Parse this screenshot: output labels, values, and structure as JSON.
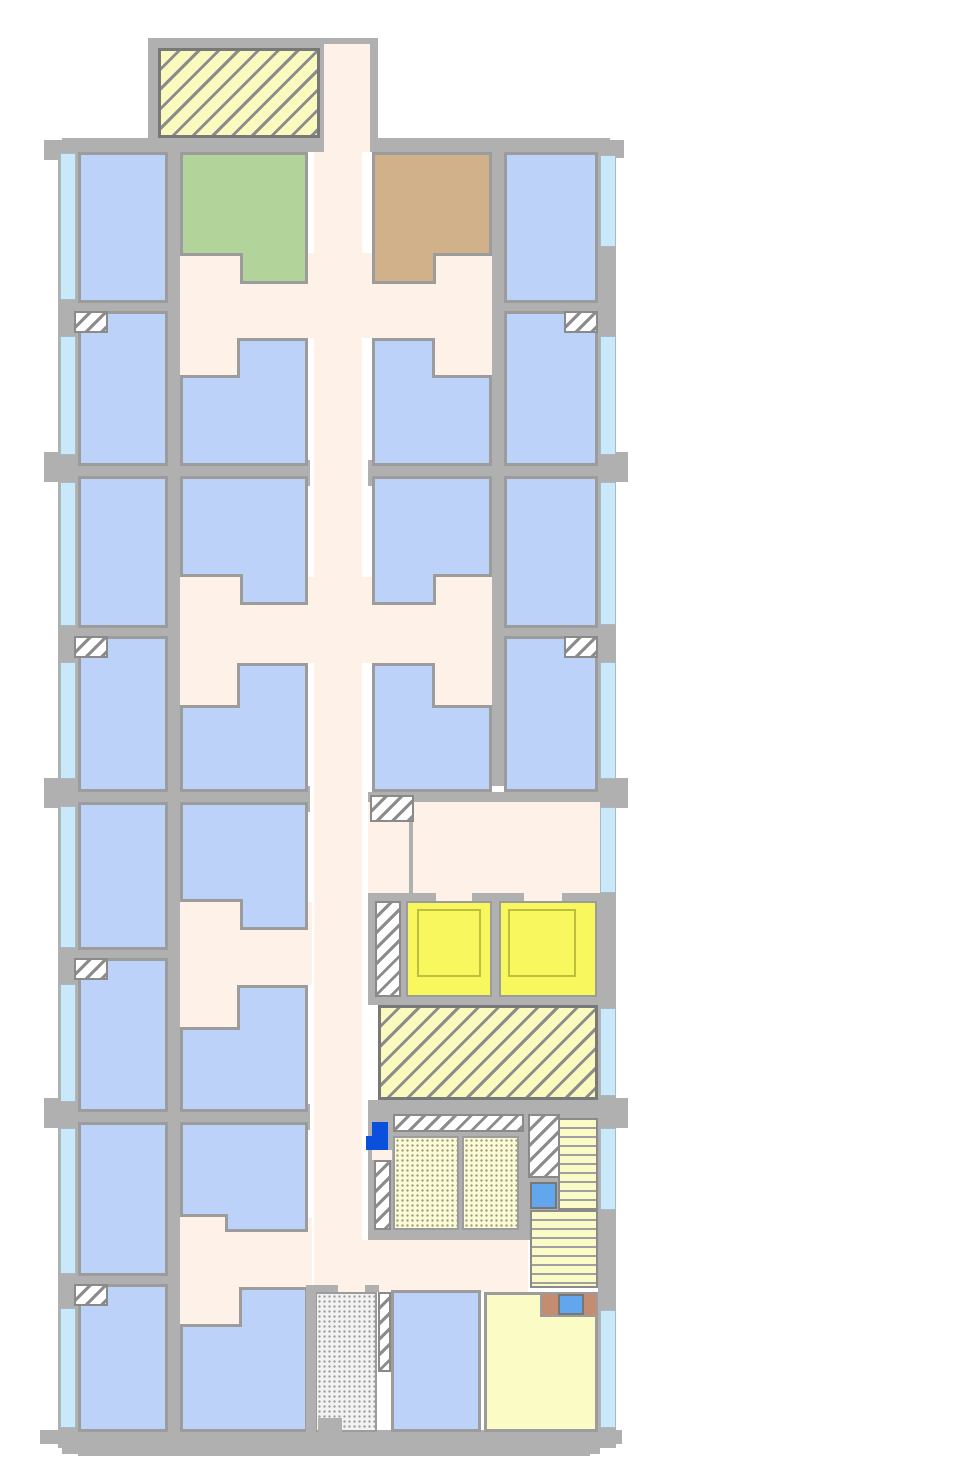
{
  "canvas": {
    "width": 960,
    "height": 1484,
    "background": "#ffffff"
  },
  "palette": {
    "wall_gray": "#b0b0b0",
    "wall_dark": "#8f8f8f",
    "corridor_cream": "#fdf1e8",
    "glazing_cyan": "#c9e9fb",
    "room_blue": "#bdd2f8",
    "room_green": "#b2d49a",
    "room_tan": "#d0b189",
    "pale_yellow": "#fafabe",
    "elevator_yellow": "#f8f85e",
    "equipment_blue": "#0a50dd",
    "landing_blue": "#62a7ee",
    "counter_brown": "#c48d72",
    "room_border": "#9c9c9c"
  },
  "shapes": [
    {
      "n": "annex-walls",
      "c": "wall",
      "r": [
        148,
        38,
        230,
        114
      ]
    },
    {
      "n": "facade-top-wall",
      "c": "wall",
      "r": [
        62,
        138,
        548,
        14
      ]
    },
    {
      "n": "facade-left-wall",
      "c": "wall",
      "r": [
        58,
        152,
        20,
        1284
      ]
    },
    {
      "n": "facade-right-wall",
      "c": "wall",
      "r": [
        598,
        152,
        18,
        1284
      ]
    },
    {
      "n": "facade-bottom-wall",
      "c": "wall",
      "r": [
        58,
        1430,
        558,
        18
      ]
    },
    {
      "n": "facade-bottom-lip",
      "c": "wall",
      "r": [
        78,
        1448,
        512,
        8
      ]
    },
    {
      "n": "corner-column-top-left",
      "c": "wall",
      "r": [
        44,
        140,
        40,
        20
      ]
    },
    {
      "n": "corner-column-top-right",
      "c": "wall",
      "r": [
        580,
        140,
        44,
        18
      ]
    },
    {
      "n": "corner-footing-bottom-left-a",
      "c": "wall",
      "r": [
        40,
        1430,
        48,
        14
      ]
    },
    {
      "n": "corner-footing-bottom-left-b",
      "c": "wall",
      "r": [
        62,
        1428,
        30,
        26
      ]
    },
    {
      "n": "corner-footing-bottom-right-a",
      "c": "wall",
      "r": [
        574,
        1430,
        48,
        14
      ]
    },
    {
      "n": "corner-footing-bottom-right-b",
      "c": "wall",
      "r": [
        570,
        1428,
        30,
        26
      ]
    },
    {
      "n": "column-left-1",
      "c": "wall",
      "r": [
        44,
        452,
        34,
        30
      ]
    },
    {
      "n": "column-left-2",
      "c": "wall",
      "r": [
        44,
        778,
        34,
        30
      ]
    },
    {
      "n": "column-left-3",
      "c": "wall",
      "r": [
        44,
        1098,
        34,
        30
      ]
    },
    {
      "n": "column-right-1",
      "c": "wall",
      "r": [
        598,
        452,
        30,
        30
      ]
    },
    {
      "n": "column-right-2",
      "c": "wall",
      "r": [
        598,
        778,
        30,
        30
      ]
    },
    {
      "n": "column-right-3",
      "c": "wall",
      "r": [
        598,
        1098,
        30,
        30
      ]
    },
    {
      "n": "party-wall-left",
      "c": "wall",
      "r": [
        168,
        152,
        12,
        1284
      ]
    },
    {
      "n": "party-wall-right",
      "c": "wall",
      "r": [
        492,
        152,
        12,
        634
      ]
    },
    {
      "n": "crosswall-1-left",
      "c": "wall",
      "r": [
        58,
        466,
        252,
        10
      ]
    },
    {
      "n": "crosswall-1-pier-left",
      "c": "wall",
      "r": [
        274,
        460,
        36,
        26
      ]
    },
    {
      "n": "crosswall-1-right",
      "c": "wall",
      "r": [
        368,
        466,
        248,
        10
      ]
    },
    {
      "n": "crosswall-1-pier-right",
      "c": "wall",
      "r": [
        368,
        460,
        18,
        26
      ]
    },
    {
      "n": "crosswall-2-left",
      "c": "wall",
      "r": [
        58,
        792,
        252,
        10
      ]
    },
    {
      "n": "crosswall-2-pier-left",
      "c": "wall",
      "r": [
        274,
        786,
        36,
        26
      ]
    },
    {
      "n": "crosswall-2-right",
      "c": "wall",
      "r": [
        368,
        792,
        248,
        10
      ]
    },
    {
      "n": "crosswall-3-left",
      "c": "wall",
      "r": [
        58,
        1112,
        252,
        10
      ]
    },
    {
      "n": "crosswall-3-pier-left",
      "c": "wall",
      "r": [
        274,
        1104,
        36,
        26
      ]
    },
    {
      "n": "crosswall-3-right-slab",
      "c": "wall",
      "r": [
        368,
        1100,
        248,
        22
      ]
    },
    {
      "n": "divider-left-1",
      "c": "wall",
      "r": [
        58,
        303,
        110,
        8
      ]
    },
    {
      "n": "divider-left-2",
      "c": "wall",
      "r": [
        58,
        628,
        110,
        8
      ]
    },
    {
      "n": "divider-left-3",
      "c": "wall",
      "r": [
        58,
        950,
        110,
        8
      ]
    },
    {
      "n": "divider-left-4",
      "c": "wall",
      "r": [
        58,
        1276,
        110,
        8
      ]
    },
    {
      "n": "divider-right-1",
      "c": "wall",
      "r": [
        504,
        303,
        110,
        8
      ]
    },
    {
      "n": "divider-right-2",
      "c": "wall",
      "r": [
        504,
        628,
        110,
        8
      ]
    },
    {
      "n": "elevator-bank-walls",
      "c": "wall",
      "r": [
        368,
        893,
        232,
        112
      ]
    },
    {
      "n": "service-core-walls",
      "c": "wall",
      "r": [
        368,
        1112,
        232,
        128
      ]
    },
    {
      "n": "annex-hall",
      "c": "cream",
      "r": [
        324,
        44,
        46,
        108
      ]
    },
    {
      "n": "central-corridor",
      "c": "cream",
      "r": [
        314,
        152,
        48,
        1140
      ]
    },
    {
      "n": "lobby-band-1",
      "c": "cream",
      "r": [
        180,
        253,
        312,
        85
      ]
    },
    {
      "n": "lobby-band-2",
      "c": "cream",
      "r": [
        180,
        577,
        312,
        86
      ]
    },
    {
      "n": "lobby-band-3-left",
      "c": "cream",
      "r": [
        180,
        902,
        132,
        83
      ]
    },
    {
      "n": "lobby-band-4-left",
      "c": "cream",
      "r": [
        180,
        1218,
        132,
        74
      ]
    },
    {
      "n": "service-hall",
      "c": "cream",
      "r": [
        362,
        1240,
        166,
        52
      ]
    },
    {
      "n": "elevator-lobby",
      "c": "cream",
      "r": [
        368,
        802,
        232,
        91
      ]
    },
    {
      "n": "window-left-1",
      "c": "cyan",
      "r": [
        60,
        153,
        16,
        147
      ]
    },
    {
      "n": "window-left-2",
      "c": "cyan",
      "r": [
        60,
        336,
        16,
        119
      ]
    },
    {
      "n": "window-left-3",
      "c": "cyan",
      "r": [
        60,
        482,
        16,
        144
      ]
    },
    {
      "n": "window-left-4",
      "c": "cyan",
      "r": [
        60,
        662,
        16,
        117
      ]
    },
    {
      "n": "window-left-5",
      "c": "cyan",
      "r": [
        60,
        806,
        16,
        142
      ]
    },
    {
      "n": "window-left-6",
      "c": "cyan",
      "r": [
        60,
        984,
        16,
        118
      ]
    },
    {
      "n": "window-left-7",
      "c": "cyan",
      "r": [
        60,
        1128,
        16,
        146
      ]
    },
    {
      "n": "window-left-8",
      "c": "cyan",
      "r": [
        60,
        1308,
        16,
        120
      ]
    },
    {
      "n": "window-right-1",
      "c": "cyan",
      "r": [
        600,
        155,
        16,
        92
      ]
    },
    {
      "n": "window-right-2",
      "c": "cyan",
      "r": [
        600,
        336,
        16,
        119
      ]
    },
    {
      "n": "window-right-3",
      "c": "cyan",
      "r": [
        600,
        482,
        16,
        143
      ]
    },
    {
      "n": "window-right-4",
      "c": "cyan",
      "r": [
        600,
        662,
        16,
        117
      ]
    },
    {
      "n": "window-right-5",
      "c": "cyan",
      "r": [
        600,
        807,
        16,
        86
      ]
    },
    {
      "n": "window-right-6",
      "c": "cyan",
      "r": [
        600,
        1008,
        16,
        88
      ]
    },
    {
      "n": "window-right-7",
      "c": "cyan",
      "r": [
        600,
        1128,
        16,
        82
      ]
    },
    {
      "n": "window-right-8",
      "c": "cyan",
      "r": [
        600,
        1310,
        16,
        118
      ]
    },
    {
      "n": "annex-shaft-hatched",
      "c": "hatch-yellow",
      "r": [
        158,
        48,
        162,
        90
      ]
    },
    {
      "n": "room-outer-left-1",
      "c": "room",
      "r": [
        78,
        152,
        90,
        151
      ]
    },
    {
      "n": "room-outer-left-2",
      "c": "room",
      "r": [
        78,
        311,
        90,
        155
      ]
    },
    {
      "n": "room-outer-left-3",
      "c": "room",
      "r": [
        78,
        476,
        90,
        152
      ]
    },
    {
      "n": "room-outer-left-4",
      "c": "room",
      "r": [
        78,
        636,
        90,
        156
      ]
    },
    {
      "n": "room-outer-left-5",
      "c": "room",
      "r": [
        78,
        802,
        90,
        148
      ]
    },
    {
      "n": "room-outer-left-6",
      "c": "room",
      "r": [
        78,
        958,
        90,
        154
      ]
    },
    {
      "n": "room-outer-left-7",
      "c": "room",
      "r": [
        78,
        1122,
        90,
        154
      ]
    },
    {
      "n": "room-outer-left-8",
      "c": "room",
      "r": [
        78,
        1284,
        90,
        148
      ]
    },
    {
      "n": "room-outer-right-1",
      "c": "room",
      "r": [
        504,
        152,
        94,
        151
      ]
    },
    {
      "n": "room-outer-right-2",
      "c": "room",
      "r": [
        504,
        311,
        94,
        155
      ]
    },
    {
      "n": "room-outer-right-3",
      "c": "room",
      "r": [
        504,
        476,
        94,
        152
      ]
    },
    {
      "n": "room-outer-right-4",
      "c": "room",
      "r": [
        504,
        636,
        94,
        156
      ]
    },
    {
      "n": "room-inner-left-1-green",
      "c": "room-green",
      "r": [
        180,
        152,
        128,
        104
      ]
    },
    {
      "n": "room-inner-left-1-green-ext",
      "c": "room-green",
      "r": [
        240,
        256,
        68,
        28
      ]
    },
    {
      "n": "room-inner-left-1-green-seam",
      "c": "seam-green",
      "r": [
        243,
        252,
        62,
        8
      ]
    },
    {
      "n": "room-inner-left-2",
      "c": "room",
      "r": [
        180,
        338,
        128,
        128
      ]
    },
    {
      "n": "entry-notch-il2",
      "c": "notch notch-tl",
      "r": [
        180,
        338,
        60,
        40
      ]
    },
    {
      "n": "room-inner-left-3",
      "c": "room",
      "r": [
        180,
        476,
        128,
        101
      ]
    },
    {
      "n": "room-inner-left-3-ext",
      "c": "room",
      "r": [
        240,
        577,
        68,
        28
      ]
    },
    {
      "n": "room-inner-left-3-seam",
      "c": "seam-blue",
      "r": [
        243,
        573,
        62,
        8
      ]
    },
    {
      "n": "room-inner-left-4",
      "c": "room",
      "r": [
        180,
        663,
        128,
        129
      ]
    },
    {
      "n": "entry-notch-il4",
      "c": "notch notch-tl",
      "r": [
        180,
        663,
        60,
        45
      ]
    },
    {
      "n": "room-inner-left-5",
      "c": "room",
      "r": [
        180,
        802,
        128,
        100
      ]
    },
    {
      "n": "room-inner-left-5-ext",
      "c": "room",
      "r": [
        240,
        902,
        68,
        28
      ]
    },
    {
      "n": "room-inner-left-5-seam",
      "c": "seam-blue",
      "r": [
        243,
        898,
        62,
        8
      ]
    },
    {
      "n": "room-inner-left-6",
      "c": "room",
      "r": [
        180,
        985,
        128,
        127
      ]
    },
    {
      "n": "entry-notch-il6",
      "c": "notch notch-tl",
      "r": [
        180,
        985,
        60,
        45
      ]
    },
    {
      "n": "room-inner-left-7",
      "c": "room",
      "r": [
        180,
        1122,
        128,
        110
      ]
    },
    {
      "n": "entry-notch-il7",
      "c": "notch notch-bl",
      "r": [
        180,
        1214,
        48,
        18
      ]
    },
    {
      "n": "room-inner-left-8",
      "c": "room",
      "r": [
        180,
        1287,
        128,
        145
      ]
    },
    {
      "n": "entry-notch-il8",
      "c": "notch notch-tl",
      "r": [
        180,
        1287,
        62,
        40
      ]
    },
    {
      "n": "room-inner-right-1-tan",
      "c": "room-tan",
      "r": [
        372,
        152,
        120,
        104
      ]
    },
    {
      "n": "room-inner-right-1-tan-ext",
      "c": "room-tan",
      "r": [
        372,
        256,
        64,
        28
      ]
    },
    {
      "n": "room-inner-right-1-tan-seam",
      "c": "seam-tan",
      "r": [
        375,
        252,
        58,
        8
      ]
    },
    {
      "n": "room-inner-right-2",
      "c": "room",
      "r": [
        372,
        338,
        120,
        128
      ]
    },
    {
      "n": "entry-notch-ir2",
      "c": "notch notch-tr",
      "r": [
        432,
        338,
        60,
        40
      ]
    },
    {
      "n": "room-inner-right-3",
      "c": "room",
      "r": [
        372,
        476,
        120,
        101
      ]
    },
    {
      "n": "room-inner-right-3-ext",
      "c": "room",
      "r": [
        372,
        577,
        64,
        28
      ]
    },
    {
      "n": "room-inner-right-3-seam",
      "c": "seam-blue",
      "r": [
        375,
        573,
        58,
        8
      ]
    },
    {
      "n": "room-inner-right-4",
      "c": "room",
      "r": [
        372,
        663,
        120,
        129
      ]
    },
    {
      "n": "entry-notch-ir4",
      "c": "notch notch-tr",
      "r": [
        432,
        663,
        60,
        45
      ]
    },
    {
      "n": "room-bottom-center-blue",
      "c": "room",
      "r": [
        391,
        1290,
        90,
        142
      ]
    },
    {
      "n": "room-bottom-right-yellow",
      "c": "room-yellow",
      "r": [
        484,
        1292,
        114,
        140
      ]
    },
    {
      "n": "riser-hatch-left-1",
      "c": "hatch-white",
      "r": [
        74,
        311,
        34,
        22
      ]
    },
    {
      "n": "riser-hatch-left-2",
      "c": "hatch-white",
      "r": [
        74,
        636,
        34,
        22
      ]
    },
    {
      "n": "riser-hatch-left-3",
      "c": "hatch-white",
      "r": [
        74,
        958,
        34,
        22
      ]
    },
    {
      "n": "riser-hatch-left-4",
      "c": "hatch-white",
      "r": [
        74,
        1284,
        34,
        22
      ]
    },
    {
      "n": "riser-hatch-right-1",
      "c": "hatch-white",
      "r": [
        564,
        311,
        34,
        22
      ]
    },
    {
      "n": "riser-hatch-right-2",
      "c": "hatch-white",
      "r": [
        564,
        636,
        34,
        22
      ]
    },
    {
      "n": "lobby-shaft-hatch",
      "c": "hatch-white",
      "r": [
        370,
        795,
        44,
        27
      ]
    },
    {
      "n": "lobby-partition-wall",
      "c": "wall",
      "r": [
        409,
        822,
        4,
        71
      ]
    },
    {
      "n": "elevator-door-gap-1",
      "c": "gap",
      "r": [
        436,
        893,
        36,
        12
      ]
    },
    {
      "n": "elevator-door-gap-2",
      "c": "gap",
      "r": [
        524,
        893,
        38,
        12
      ]
    },
    {
      "n": "elevator-shaft-hatch",
      "c": "hatch-white",
      "r": [
        375,
        901,
        26,
        96
      ]
    },
    {
      "n": "elevator-car-1",
      "c": "car",
      "r": [
        406,
        901,
        86,
        96
      ]
    },
    {
      "n": "elevator-car-1-cab",
      "c": "car-inner",
      "r": [
        417,
        909,
        64,
        68
      ]
    },
    {
      "n": "elevator-car-2",
      "c": "car",
      "r": [
        499,
        901,
        98,
        96
      ]
    },
    {
      "n": "elevator-car-2-cab",
      "c": "car-inner",
      "r": [
        508,
        909,
        68,
        68
      ]
    },
    {
      "n": "mechanical-room-hatched",
      "c": "hatch-yellow",
      "r": [
        378,
        1005,
        220,
        95
      ]
    },
    {
      "n": "service-hatch-strip-top",
      "c": "hatch-white",
      "r": [
        393,
        1114,
        131,
        18
      ]
    },
    {
      "n": "service-hatch-block",
      "c": "hatch-white",
      "r": [
        528,
        1114,
        32,
        64
      ]
    },
    {
      "n": "restroom-dotted-1",
      "c": "dots",
      "r": [
        393,
        1136,
        66,
        94
      ]
    },
    {
      "n": "restroom-dotted-2",
      "c": "dots",
      "r": [
        462,
        1136,
        57,
        94
      ]
    },
    {
      "n": "service-hatch-strip-left",
      "c": "hatch-white",
      "r": [
        374,
        1160,
        17,
        70
      ]
    },
    {
      "n": "equipment-box-blue-1",
      "c": "box-blue-dark",
      "r": [
        372,
        1122,
        16,
        14
      ]
    },
    {
      "n": "equipment-box-blue-2",
      "c": "box-blue-dark",
      "r": [
        366,
        1136,
        22,
        14
      ]
    },
    {
      "n": "service-pocket",
      "c": "cream",
      "r": [
        372,
        1150,
        20,
        10
      ]
    },
    {
      "n": "stair-upper-run",
      "c": "treads",
      "r": [
        558,
        1118,
        40,
        92
      ]
    },
    {
      "n": "stair-landing-square",
      "c": "box-blue-med",
      "r": [
        530,
        1182,
        27,
        27
      ]
    },
    {
      "n": "stair-lower-run",
      "c": "treads",
      "r": [
        530,
        1210,
        68,
        78
      ]
    },
    {
      "n": "ramp-stippled",
      "c": "stipple",
      "r": [
        315,
        1292,
        62,
        140
      ]
    },
    {
      "n": "ramp-wall-top-1",
      "c": "wall",
      "r": [
        306,
        1285,
        32,
        7
      ]
    },
    {
      "n": "ramp-wall-top-2",
      "c": "wall",
      "r": [
        365,
        1285,
        14,
        7
      ]
    },
    {
      "n": "ramp-wall-left",
      "c": "wall",
      "r": [
        306,
        1287,
        10,
        145
      ]
    },
    {
      "n": "ramp-notch",
      "c": "wall",
      "r": [
        318,
        1418,
        24,
        16
      ]
    },
    {
      "n": "shaft-hatch-bottom",
      "c": "hatch-white",
      "r": [
        378,
        1292,
        13,
        80
      ]
    },
    {
      "n": "counter-brown-box",
      "c": "box-brown",
      "r": [
        540,
        1292,
        58,
        25
      ]
    },
    {
      "n": "counter-blue-square",
      "c": "box-blue-med",
      "r": [
        558,
        1294,
        26,
        21
      ]
    }
  ]
}
